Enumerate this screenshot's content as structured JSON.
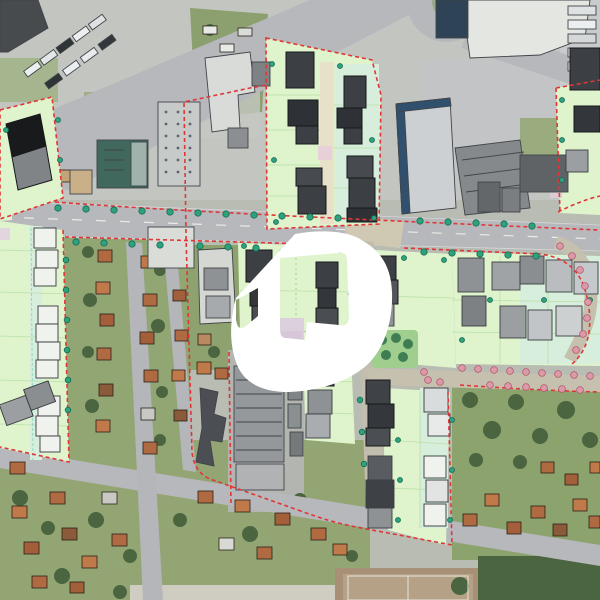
{
  "palette": {
    "aerial_base": "#b9bcb2",
    "road_gray": "#b6b8bc",
    "plan_road_tan": "#c6c1ae",
    "masterplan_green": "#dff4cd",
    "masterplan_mint": "#d6eedb",
    "boundary_red": "#e13636",
    "building_dark": "#3c4044",
    "building_black": "#191a1c",
    "building_gray": "#9b9fa2",
    "building_white": "#f0f2ee",
    "existing_white": "#e4e6e2",
    "teal_roof": "#41685c",
    "blue_edge": "#30506e",
    "roof_orange": "#b06a42",
    "tree_green": "#47613a",
    "grass_green": "#8fa671",
    "dot_teal": "#2ea27d",
    "dot_pink": "#dc9aa8",
    "path_beige": "#e7e1c9",
    "field_clay": "#a89076",
    "logo_white": "#ffffff"
  },
  "watermark": {
    "name": "logo-watermark",
    "color": "#ffffff"
  },
  "overlay": {
    "boundary_dash_pattern": "4 3"
  }
}
